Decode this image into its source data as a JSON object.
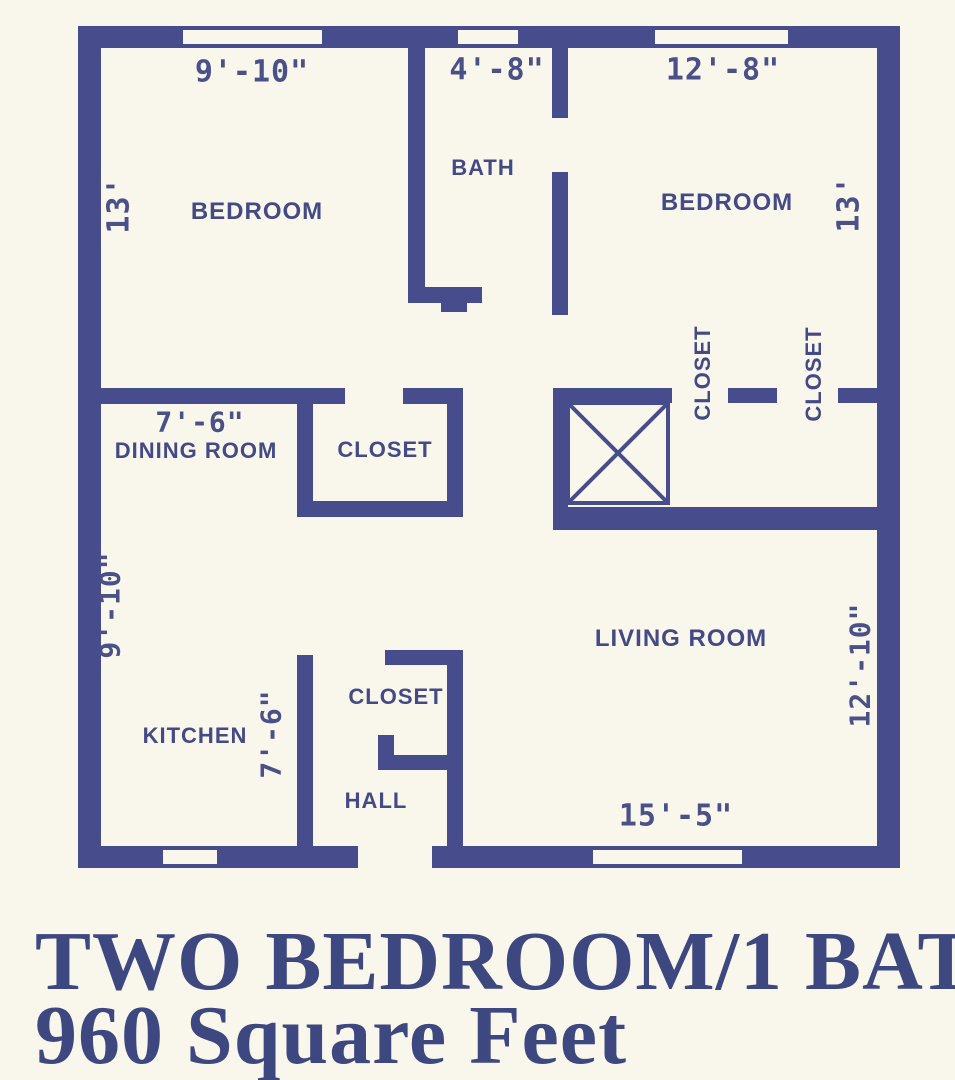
{
  "rooms": [
    {
      "id": "bedroom-left",
      "label": "BEDROOM",
      "width": "9'-10\"",
      "depth": "13'"
    },
    {
      "id": "bath",
      "label": "BATH",
      "width": "4'-8\""
    },
    {
      "id": "bedroom-right",
      "label": "BEDROOM",
      "width": "12'-8\"",
      "depth": "13'"
    },
    {
      "id": "dining-room",
      "label": "DINING ROOM",
      "width": "7'-6\""
    },
    {
      "id": "closet-dining",
      "label": "CLOSET"
    },
    {
      "id": "closet-bedroom-1",
      "label": "CLOSET"
    },
    {
      "id": "closet-bedroom-2",
      "label": "CLOSET"
    },
    {
      "id": "kitchen",
      "label": "KITCHEN",
      "depth": "9'-10\"",
      "hall_width": "7'-6\""
    },
    {
      "id": "closet-hall",
      "label": "CLOSET"
    },
    {
      "id": "hall",
      "label": "HALL"
    },
    {
      "id": "living-room",
      "label": "LIVING ROOM",
      "width": "15'-5\"",
      "depth": "12'-10\""
    }
  ],
  "footer": {
    "line1": "TWO BEDROOM/1 BATH",
    "line2": "960 Square Feet"
  },
  "colors": {
    "wall": "#474c8c",
    "ink": "#434a85",
    "title": "#3d4780",
    "background": "#f9f6ec"
  }
}
